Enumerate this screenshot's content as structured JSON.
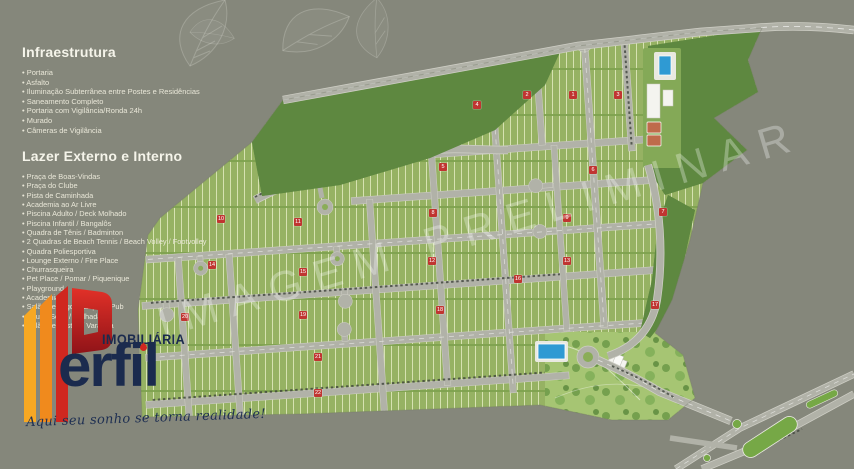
{
  "page": {
    "background": "#85877b"
  },
  "watermark": {
    "text": "IMAGEM PRELIMINAR"
  },
  "sidebar": {
    "infrastructure": {
      "title": "Infraestrutura",
      "items": [
        "Portaria",
        "Asfalto",
        "Iluminação Subterrânea entre Postes e Residências",
        "Saneamento Completo",
        "Portaria com Vigilância/Ronda 24h",
        "Murado",
        "Câmeras de Vigilância"
      ]
    },
    "leisure": {
      "title": "Lazer Externo e Interno",
      "items": [
        "Praça de Boas-Vindas",
        "Praça do Clube",
        "Pista de Caminhada",
        "Academia ao Ar Livre",
        "Piscina Adulto / Deck Molhado",
        "Piscina Infantil / Bangalôs",
        "Quadra de Tênis / Badminton",
        "2 Quadras de Beach Tennis / Beach Volley / Footvolley",
        "Quadra Poliesportiva",
        "Lounge Externo / Fire Place",
        "Churrasqueira",
        "Pet Place / Pomar / Piquenique",
        "Playground",
        "Academia",
        "Salão de Jogos / Espaço Pub",
        "Sauna Seca / Molhada",
        "Salão de Festas / Varanda"
      ]
    }
  },
  "logo": {
    "sector_label": "IMOBILIÁRIA",
    "brand_text": "erfil",
    "brand_full": "Perfil",
    "tagline": "Aqui seu sonho se torna realidade!",
    "colors": {
      "navy": "#1b2b4e",
      "yellow": "#f7a823",
      "orange": "#f08a1d",
      "red": "#d0271f"
    }
  },
  "map": {
    "colors": {
      "background": "#85877b",
      "lot_green": "#96b263",
      "forest_green": "#5e8840",
      "road_grey": "#b1b2a8",
      "badge_red": "#c03531",
      "pool_blue": "#2f9ad3",
      "court_clay": "#bf6b4b",
      "median_green": "#76a846"
    },
    "block_badges": [
      {
        "n": "1",
        "x": 573,
        "y": 95
      },
      {
        "n": "2",
        "x": 527,
        "y": 95
      },
      {
        "n": "3",
        "x": 618,
        "y": 95
      },
      {
        "n": "4",
        "x": 477,
        "y": 105
      },
      {
        "n": "5",
        "x": 443,
        "y": 167
      },
      {
        "n": "6",
        "x": 593,
        "y": 170
      },
      {
        "n": "7",
        "x": 663,
        "y": 212
      },
      {
        "n": "8",
        "x": 433,
        "y": 213
      },
      {
        "n": "9",
        "x": 567,
        "y": 218
      },
      {
        "n": "10",
        "x": 221,
        "y": 219
      },
      {
        "n": "11",
        "x": 298,
        "y": 222
      },
      {
        "n": "12",
        "x": 432,
        "y": 261
      },
      {
        "n": "13",
        "x": 567,
        "y": 261
      },
      {
        "n": "14",
        "x": 212,
        "y": 265
      },
      {
        "n": "15",
        "x": 303,
        "y": 272
      },
      {
        "n": "16",
        "x": 518,
        "y": 279
      },
      {
        "n": "17",
        "x": 655,
        "y": 305
      },
      {
        "n": "18",
        "x": 440,
        "y": 310
      },
      {
        "n": "19",
        "x": 303,
        "y": 315
      },
      {
        "n": "20",
        "x": 185,
        "y": 317
      },
      {
        "n": "21",
        "x": 318,
        "y": 357
      },
      {
        "n": "22",
        "x": 318,
        "y": 393
      }
    ]
  }
}
